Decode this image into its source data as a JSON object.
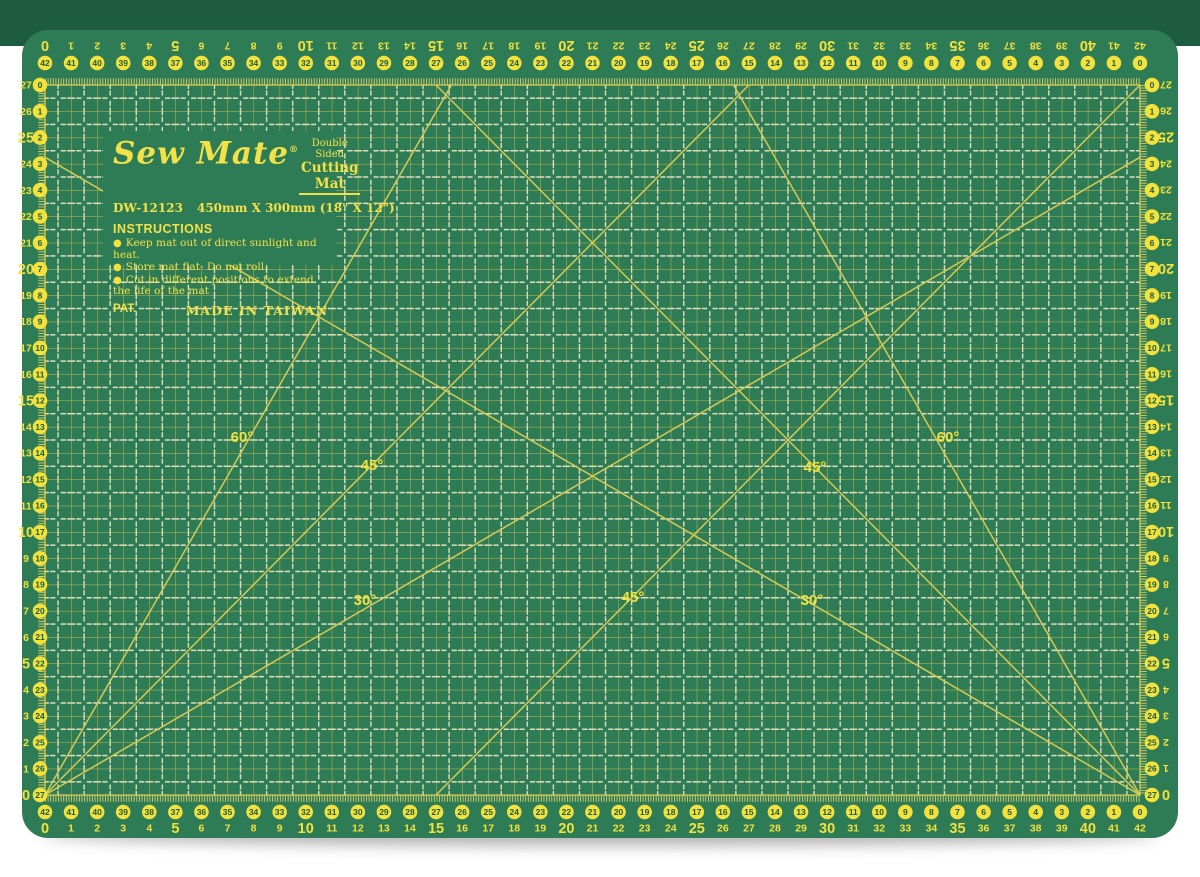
{
  "panel": {
    "brand": "Sew Mate",
    "registered": "®",
    "tagline_line1": "Double  Sided",
    "tagline_line2": "Cutting Mat",
    "model": "DW-12123",
    "size": "450mm X 300mm (18\" X 12\")",
    "instructions_title": "INSTRUCTIONS",
    "instructions": [
      "Keep mat out of direct sunlight and heat.",
      "Store mat flat- Do not roll.",
      "Cut in different positions to extend the life of the mat"
    ],
    "pat": "PAT.",
    "made_in": "MADE IN TAIWAN"
  },
  "rulers": {
    "unit": "cm",
    "horizontal_plain": [
      0,
      1,
      2,
      3,
      4,
      5,
      6,
      7,
      8,
      9,
      10,
      11,
      12,
      13,
      14,
      15,
      16,
      17,
      18,
      19,
      20,
      21,
      22,
      23,
      24,
      25,
      26,
      27,
      28,
      29,
      30,
      31,
      32,
      33,
      34,
      35,
      36,
      37,
      38,
      39,
      40,
      41,
      42
    ],
    "horizontal_circled": [
      42,
      41,
      40,
      39,
      38,
      37,
      36,
      35,
      34,
      33,
      32,
      31,
      30,
      29,
      28,
      27,
      26,
      25,
      24,
      23,
      22,
      21,
      20,
      19,
      18,
      17,
      16,
      15,
      14,
      13,
      12,
      11,
      10,
      9,
      8,
      7,
      6,
      5,
      4,
      3,
      2,
      1,
      0
    ],
    "vertical_plain": [
      27,
      26,
      25,
      24,
      23,
      22,
      21,
      20,
      19,
      18,
      17,
      16,
      15,
      14,
      13,
      12,
      11,
      10,
      9,
      8,
      7,
      6,
      5,
      4,
      3,
      2,
      1,
      0
    ],
    "vertical_circled": [
      0,
      1,
      2,
      3,
      4,
      5,
      6,
      7,
      8,
      9,
      10,
      11,
      12,
      13,
      14,
      15,
      16,
      17,
      18,
      19,
      20,
      21,
      22,
      23,
      24,
      25,
      26,
      27
    ]
  },
  "grid": {
    "columns_cm": 42,
    "rows_cm": 27
  },
  "diagonals_cm": [
    {
      "angle": "60",
      "from": [
        0,
        0
      ],
      "to": [
        15.59,
        27
      ]
    },
    {
      "angle": "45",
      "from": [
        0,
        0
      ],
      "to": [
        27,
        27
      ]
    },
    {
      "angle": "30",
      "from": [
        0,
        0
      ],
      "to": [
        42,
        24.25
      ]
    },
    {
      "angle": "60",
      "from": [
        42,
        0
      ],
      "to": [
        26.41,
        27
      ]
    },
    {
      "angle": "45",
      "from": [
        42,
        0
      ],
      "to": [
        15,
        27
      ]
    },
    {
      "angle": "30",
      "from": [
        42,
        0
      ],
      "to": [
        0,
        24.25
      ]
    },
    {
      "angle": "45",
      "from": [
        15,
        0
      ],
      "to": [
        42,
        27
      ]
    }
  ],
  "angle_labels": [
    {
      "text": "60°",
      "x": 242,
      "y": 437
    },
    {
      "text": "45°",
      "x": 372,
      "y": 465
    },
    {
      "text": "30°",
      "x": 365,
      "y": 600
    },
    {
      "text": "45°",
      "x": 633,
      "y": 597
    },
    {
      "text": "45°",
      "x": 815,
      "y": 467
    },
    {
      "text": "30°",
      "x": 812,
      "y": 600
    },
    {
      "text": "60°",
      "x": 948,
      "y": 437
    }
  ],
  "colors": {
    "mat_face": "#2e7c55",
    "mat_edge_dark": "#1d5c3e",
    "grid_line": "#c2b84e",
    "half_cm_dash": "#e2debc",
    "number_yellow": "#f3e13c",
    "circle_fill": "#f3e13c",
    "circle_text": "#1d5c3e",
    "diagonal_line": "#d6ca55",
    "tick": "#d8cd6a"
  }
}
